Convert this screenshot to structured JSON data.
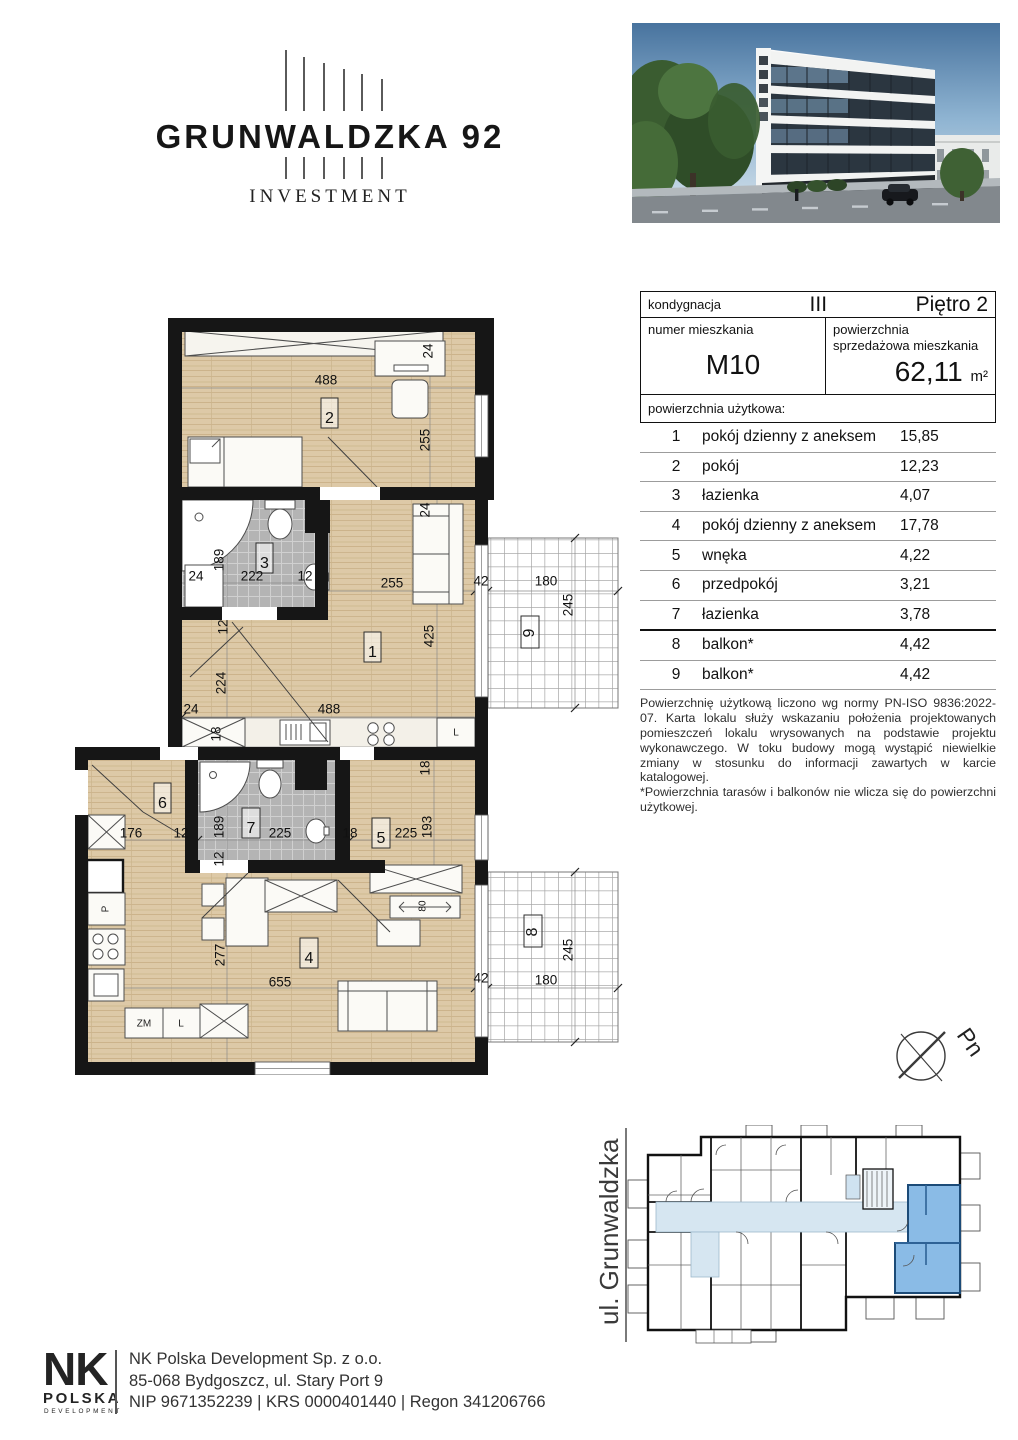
{
  "brand": {
    "title": "GRUNWALDZKA 92",
    "subtitle": "INVESTMENT"
  },
  "info": {
    "floor_label": "kondygnacja",
    "floor_value": "III",
    "floor_name": "Piętro 2",
    "unit_label": "numer mieszkania",
    "unit_value": "M10",
    "area_label": "powierzchnia sprzedażowa mieszkania",
    "area_value": "62,11",
    "area_unit": "m²",
    "usable_label": "powierzchnia użytkowa:",
    "rows": [
      {
        "nr": "1",
        "name": "pokój dzienny z aneksem",
        "area": "15,85"
      },
      {
        "nr": "2",
        "name": "pokój",
        "area": "12,23"
      },
      {
        "nr": "3",
        "name": "łazienka",
        "area": "4,07"
      },
      {
        "nr": "4",
        "name": "pokój dzienny z aneksem",
        "area": "17,78"
      },
      {
        "nr": "5",
        "name": "wnęka",
        "area": "4,22"
      },
      {
        "nr": "6",
        "name": "przedpokój",
        "area": "3,21"
      },
      {
        "nr": "7",
        "name": "łazienka",
        "area": "3,78"
      },
      {
        "nr": "8",
        "name": "balkon*",
        "area": "4,42"
      },
      {
        "nr": "9",
        "name": "balkon*",
        "area": "4,42"
      }
    ],
    "disclaimer1": "Powierzchnię użytkową liczono wg normy PN-ISO 9836:2022-07. Karta lokalu służy wskazaniu położenia projektowanych pomieszczeń lokalu wrysowanych na podstawie projektu wykonawczego. W toku budowy mogą wystąpić niewielkie zmiany w stosunku do informacji zawartych w karcie katalogowej.",
    "disclaimer2": "*Powierzchnia tarasów i balkonów nie wlicza się do powierzchni użytkowej."
  },
  "plan": {
    "rooms": [
      "1",
      "2",
      "3",
      "4",
      "5",
      "6",
      "7",
      "8",
      "9"
    ],
    "dims": [
      "488",
      "24",
      "255",
      "189",
      "24",
      "222",
      "12",
      "24",
      "255",
      "42",
      "180",
      "245",
      "425",
      "12",
      "224",
      "24",
      "488",
      "18",
      "18",
      "176",
      "12",
      "189",
      "12",
      "225",
      "18",
      "225",
      "193",
      "80",
      "277",
      "655",
      "42",
      "180",
      "245"
    ],
    "appliances": {
      "fridge1": "L",
      "oven": "P",
      "dishwasher": "ZM",
      "fridge2": "L"
    },
    "colors": {
      "wall": "#161616",
      "wood": "#ddc9a7",
      "tile": "#b4b4b4",
      "highlight": "#8abbe6"
    }
  },
  "overview": {
    "street": "ul. Grunwaldzka",
    "compass": "Pn"
  },
  "footer": {
    "logo_top": "NK",
    "logo_mid": "POLSKA",
    "logo_bottom": "DEVELOPMENT",
    "line1": "NK Polska Development Sp. z o.o.",
    "line2": "85-068 Bydgoszcz, ul. Stary Port 9",
    "line3": "NIP 9671352239 | KRS 0000401440 | Regon 341206766"
  }
}
